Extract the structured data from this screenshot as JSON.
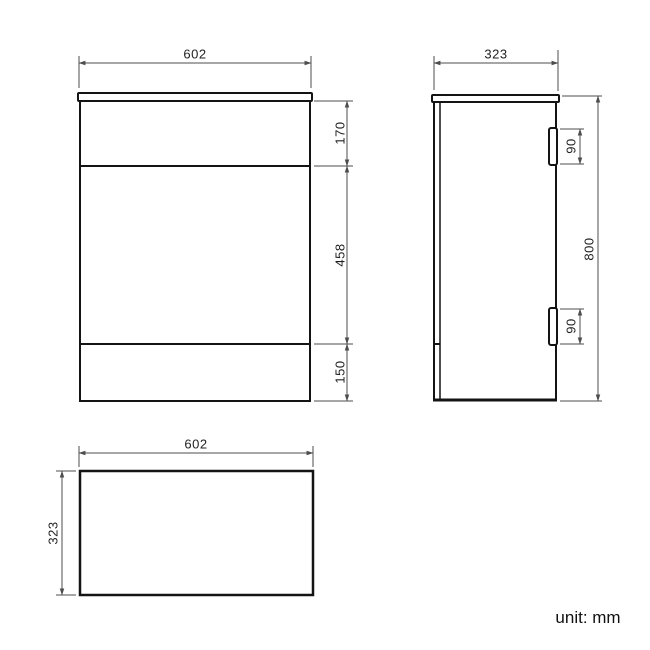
{
  "title": "cabinet-dimension-drawing",
  "unit_note": "unit: mm",
  "front_view": {
    "name": "front elevation",
    "width": "602",
    "top_section_height": "170",
    "middle_section_height": "458",
    "bottom_section_height": "150"
  },
  "side_view": {
    "name": "side elevation",
    "depth": "323",
    "height": "800",
    "top_hinge_height": "90",
    "bottom_hinge_height": "90"
  },
  "top_view": {
    "name": "plan view",
    "width": "602",
    "depth": "323"
  },
  "colors": {
    "outline": "#141414",
    "dimension_line": "#4d4d4d",
    "background": "#ffffff"
  }
}
